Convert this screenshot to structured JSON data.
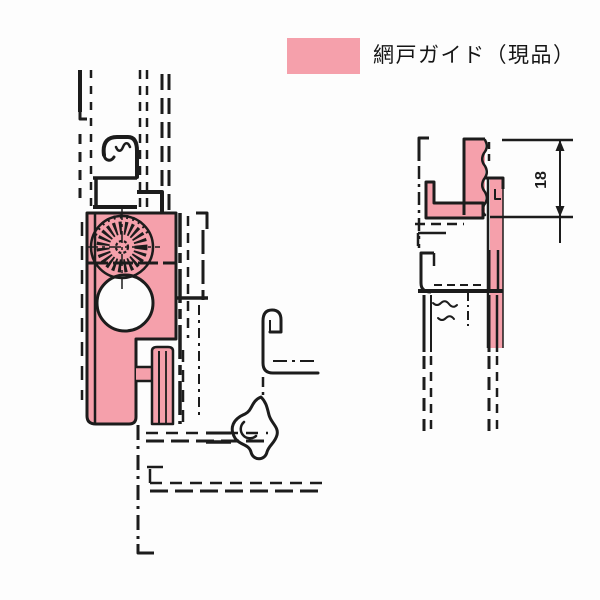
{
  "legend": {
    "label": "網戸ガイド（現品）",
    "swatch_color": "#f5a0ab"
  },
  "dimension": {
    "value": "18"
  },
  "colors": {
    "highlight_pink": "#f5a0ab",
    "line_ink": "#1c1c1c",
    "background": "#fdfdfd"
  }
}
